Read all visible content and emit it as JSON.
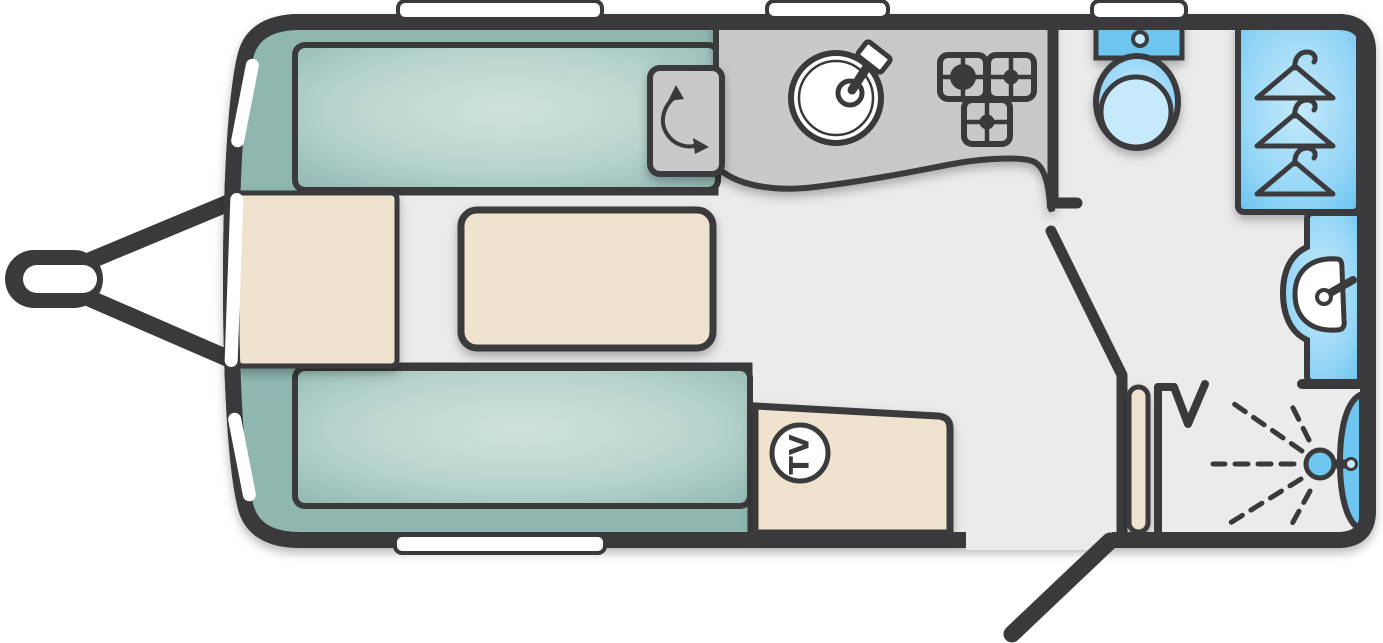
{
  "title": "Caravan floor plan",
  "labels": {
    "tv_badge": "TV"
  },
  "colors": {
    "outline": "#3a3a3c",
    "floor": "#ebebeb",
    "exterior": "#ffffff",
    "white": "#ffffff",
    "seat_dark": "#8fb7b0",
    "seat_mid": "#aac9c3",
    "seat_light": "#cfe3de",
    "cream": "#efe3cd",
    "counter": "#c9c9c9",
    "blue": "#6ec6f0",
    "blue_light": "#c6eafb"
  },
  "fixtures": {
    "front_lounge": [
      "front-bench-top",
      "front-bench-bottom",
      "front-chest",
      "occasional-table"
    ],
    "kitchen": [
      "worktop",
      "round-sink",
      "tap",
      "three-burner-hob",
      "hinged-worktop-flap"
    ],
    "entertainment": [
      "tv-cabinet",
      "tv-point"
    ],
    "washroom": [
      "toilet",
      "wardrobe-with-hangers",
      "washbasin",
      "shower"
    ],
    "exterior": [
      "tow-hitch",
      "entrance-door",
      "windows"
    ]
  }
}
